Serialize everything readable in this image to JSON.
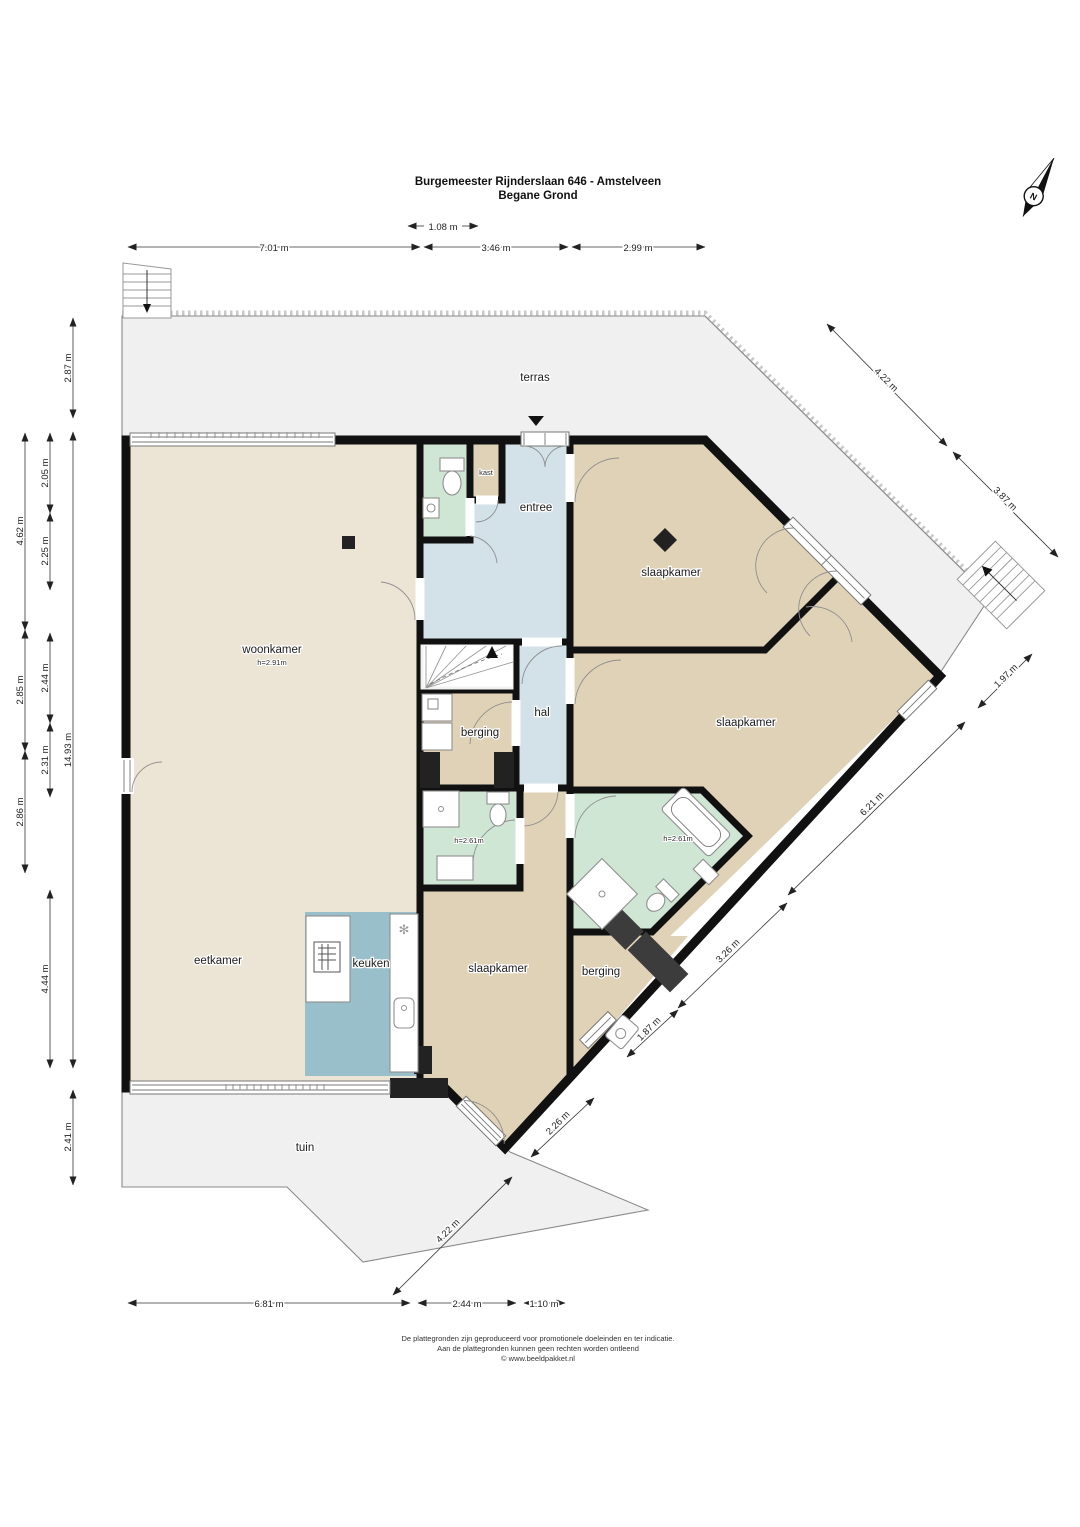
{
  "title": {
    "line1": "Burgemeester Rijnderslaan 646 - Amstelveen",
    "line2": "Begane Grond"
  },
  "compass": {
    "label": "N"
  },
  "rooms": {
    "terras": "terras",
    "tuin": "tuin",
    "woonkamer": "woonkamer",
    "woonkamer_height": "h=2.91m",
    "eetkamer": "eetkamer",
    "keuken": "keuken",
    "entree": "entree",
    "kast": "kast",
    "hal": "hal",
    "berging_mid": "berging",
    "berging_bottom": "berging",
    "slaapkamer_top": "slaapkamer",
    "slaapkamer_right": "slaapkamer",
    "slaapkamer_bottom": "slaapkamer",
    "bath1_height": "h=2.61m",
    "bath2_height": "h=2.61m"
  },
  "dimensions": {
    "top": [
      "7.01 m",
      "3.46 m",
      "2.99 m"
    ],
    "top_small": "1.08 m",
    "left_inner": [
      "2.87 m",
      "14.93 m",
      "2.41 m"
    ],
    "left_mid": [
      "2.05 m",
      "2.25 m",
      "2.44 m",
      "2.31 m",
      "4.44 m"
    ],
    "left_outer": [
      "4.62 m",
      "2.85 m",
      "2.86 m"
    ],
    "right": [
      "4.22 m",
      "3.87 m",
      "1.97 m",
      "6.21 m",
      "3.26 m",
      "1.87 m",
      "2.26 m",
      "4.22 m"
    ],
    "bottom": [
      "6.81 m",
      "2.44 m",
      "1.10 m"
    ]
  },
  "footer": {
    "line1": "De plattegronden zijn geproduceerd voor promotionele doeleinden en ter indicatie.",
    "line2": "Aan de plattegronden kunnen geen rechten worden ontleend",
    "line3": "© www.beeldpakket.nl"
  },
  "colors": {
    "wall": "#111111",
    "floor_living": "#ece4d4",
    "floor_bedroom": "#e0d2b6",
    "floor_bath": "#cfe6d4",
    "floor_hall": "#d3e2e8",
    "floor_kitchen": "#99bfca",
    "exterior_ground": "#f0f0f0"
  }
}
